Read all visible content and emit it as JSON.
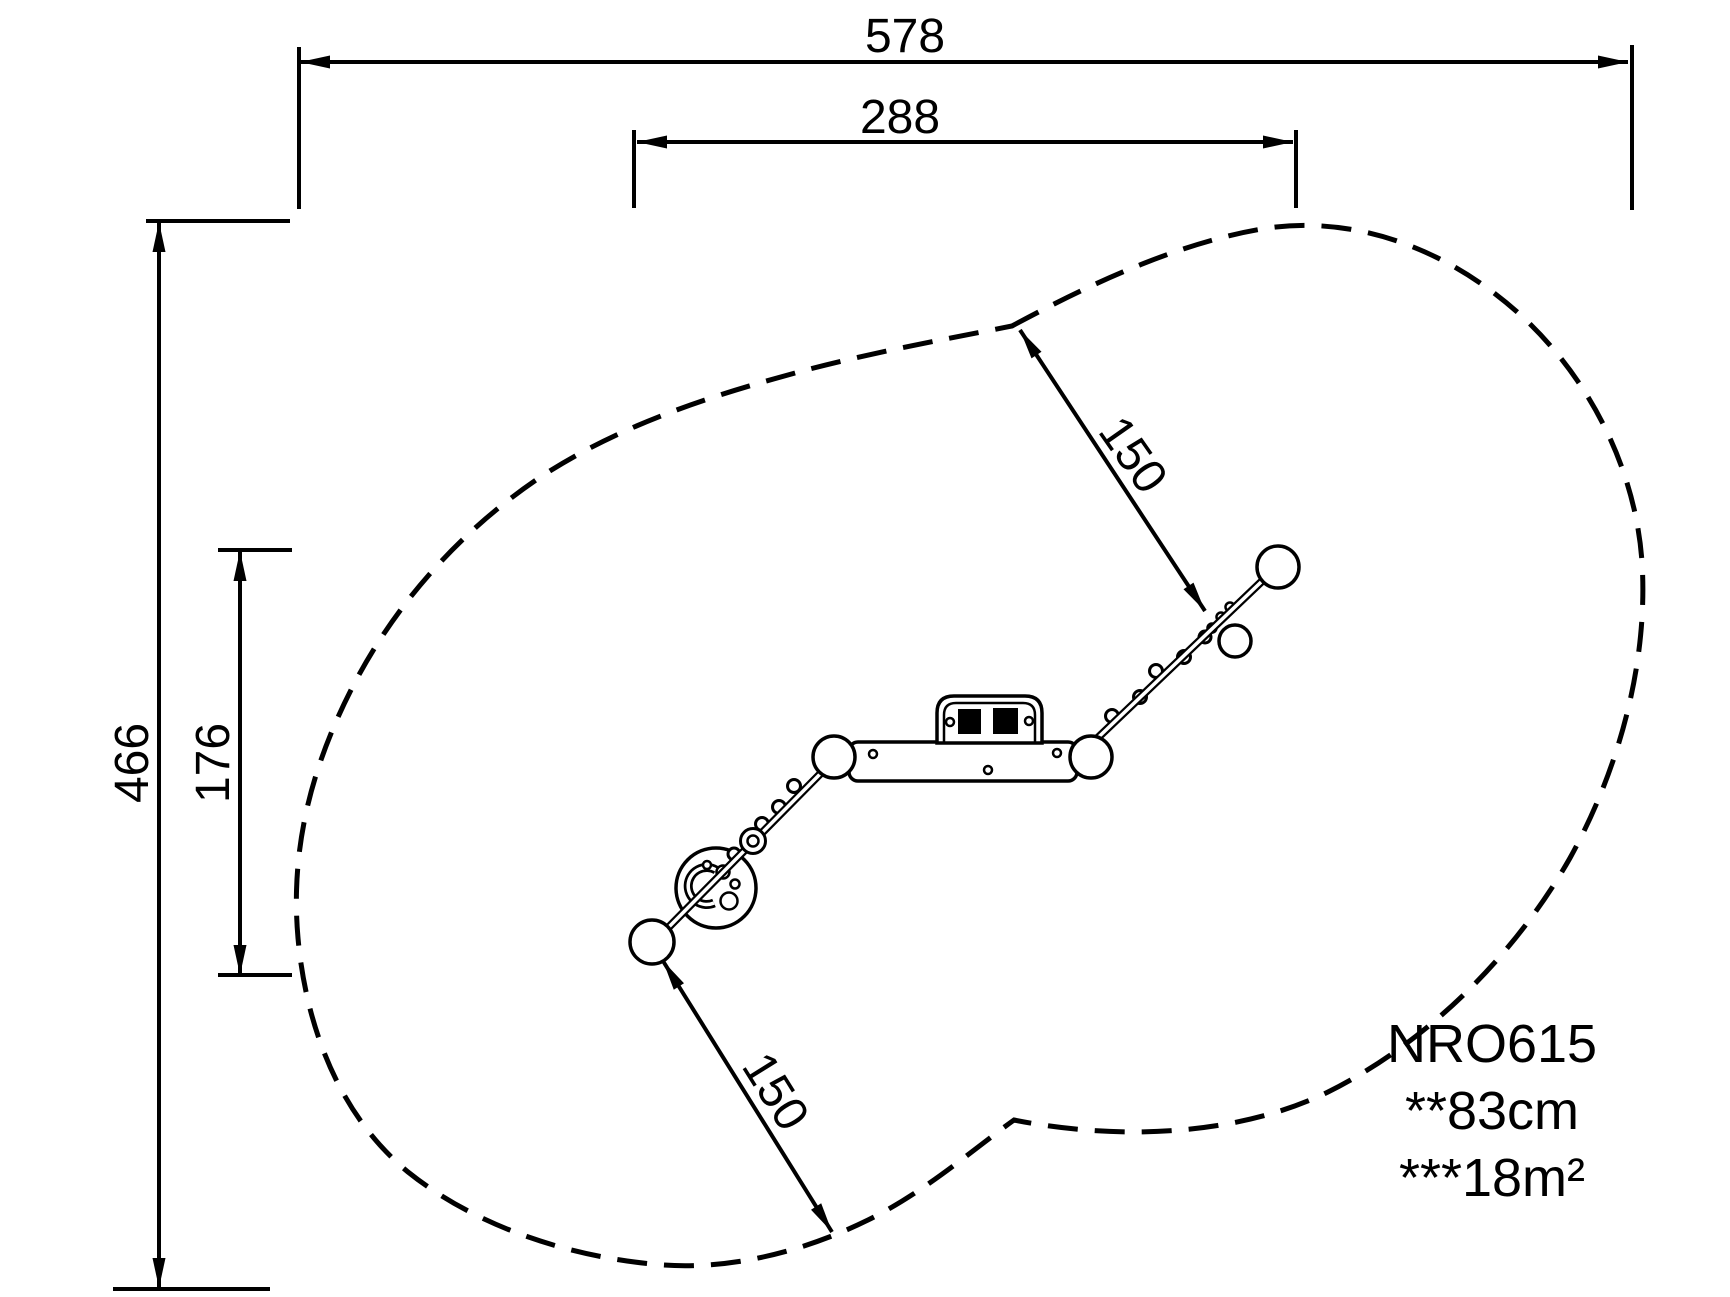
{
  "title": "Playground equipment installation plan (top view)",
  "colors": {
    "ink": "#000000",
    "background": "#ffffff"
  },
  "dimensions": {
    "overall_width": "578",
    "inner_width": "288",
    "overall_depth": "466",
    "inner_depth": "176",
    "clearance_upper": "150",
    "clearance_lower": "150"
  },
  "product": {
    "code": "NRO615",
    "fall_height": "**83cm",
    "safety_area": "***18m²"
  }
}
